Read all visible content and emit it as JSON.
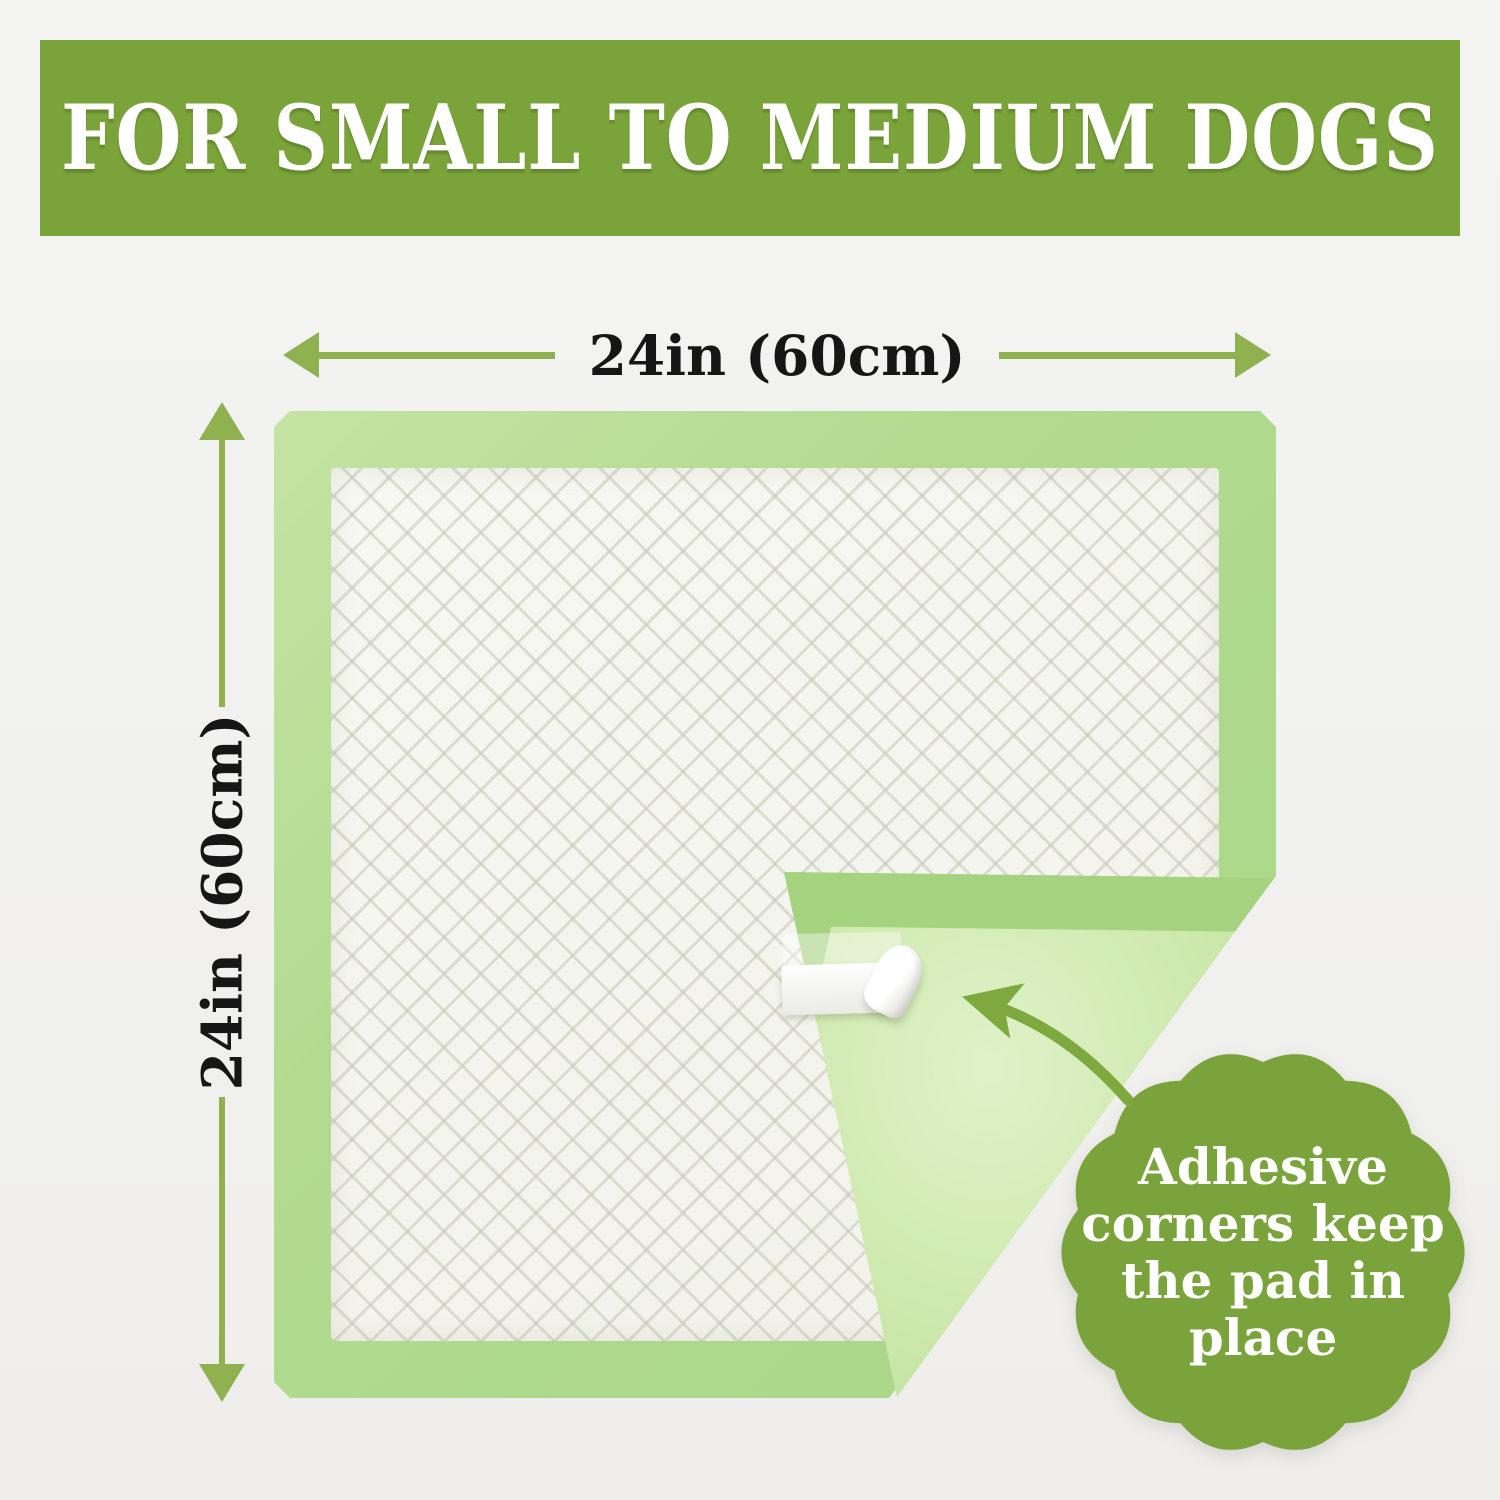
{
  "banner": {
    "title": "FOR SMALL TO MEDIUM DOGS"
  },
  "dimensions": {
    "width_label": "24in (60cm)",
    "height_label": "24in (60cm)"
  },
  "callout": {
    "lines": [
      "Adhesive",
      "corners keep",
      "the pad in",
      "place"
    ]
  },
  "icons": {
    "pointer": "curved-arrow",
    "width_arrows": "double-headed-horizontal-arrow",
    "height_arrows": "double-headed-vertical-arrow"
  },
  "colors": {
    "banner_green": "#7aa339",
    "badge_green": "#7aa43b",
    "dim_green": "#90b150",
    "pointer_green": "#7da93e",
    "pad_border": "#b2db90",
    "pad_band": "#a6d37f",
    "pad_back": "#cde9ad",
    "pad_back_light": "#e0f2c9",
    "ink": "#161616",
    "background": "#f2f2f0",
    "tape_white": "#ffffff"
  }
}
